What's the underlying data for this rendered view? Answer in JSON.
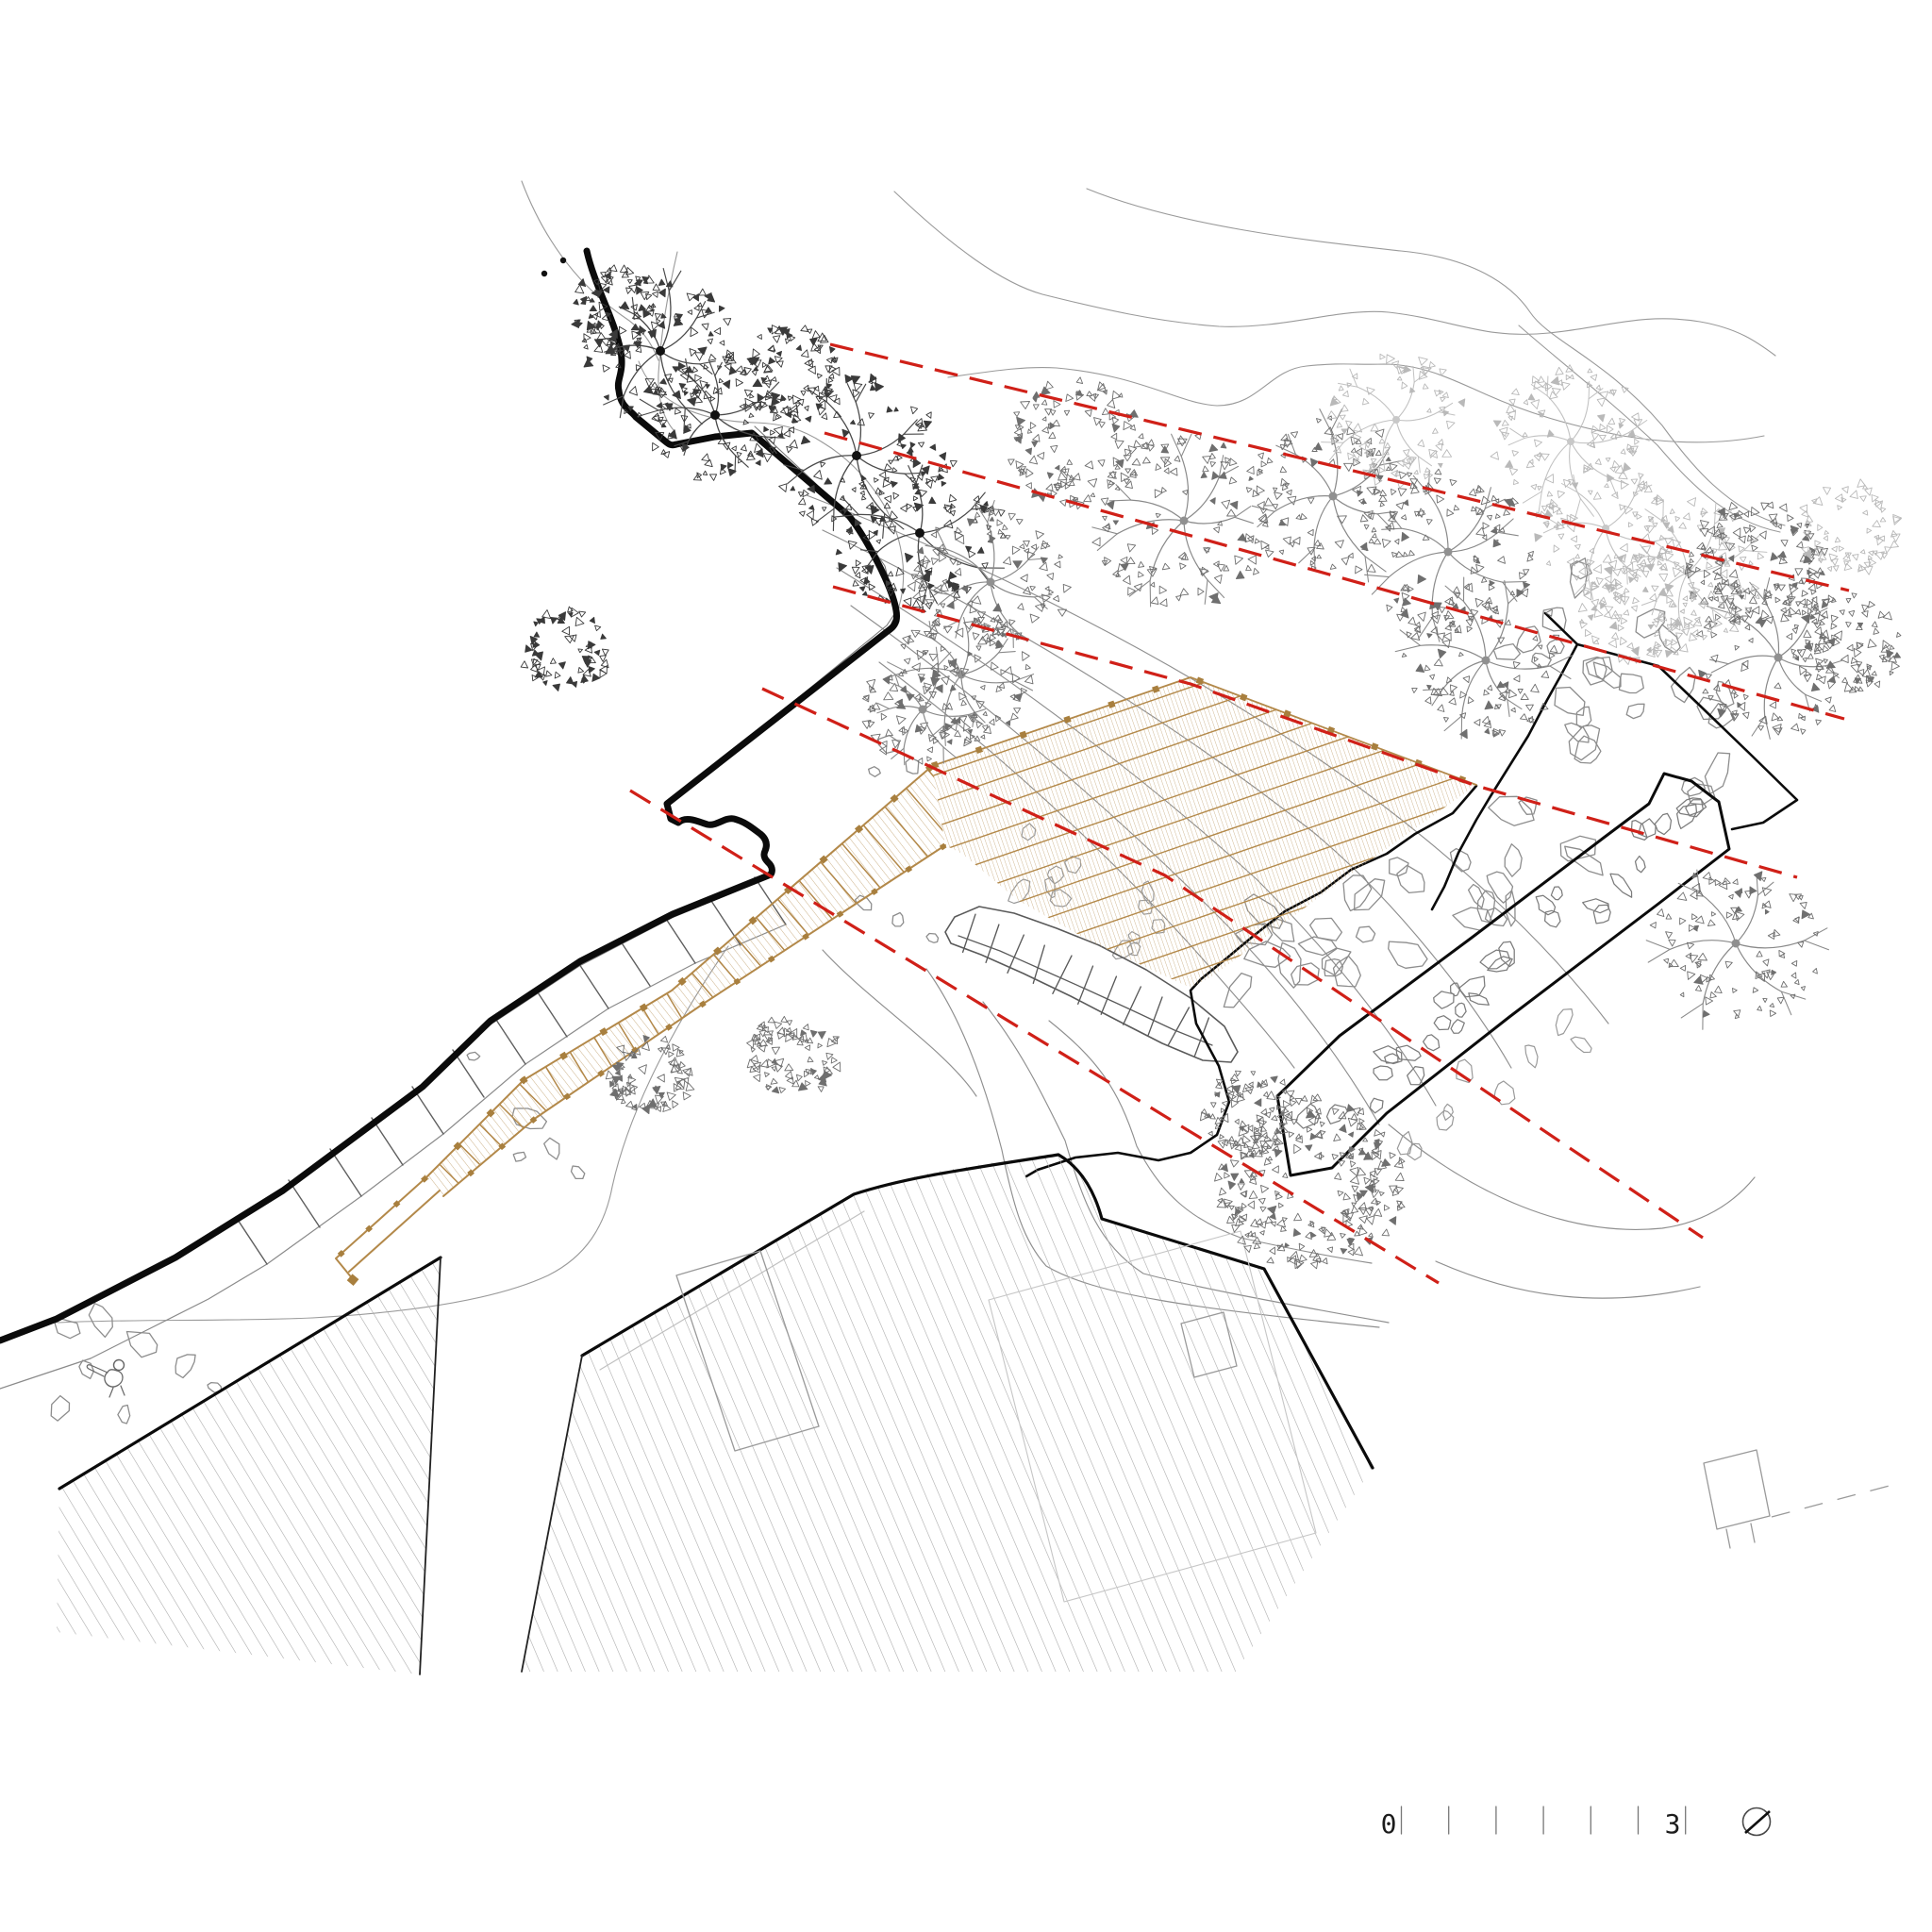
{
  "drawing": {
    "kind": "architectural-site-plan",
    "elements": {
      "deck": "timber-deck",
      "boardwalk": "timber-boardwalk",
      "breakwater": "stone-breakwater",
      "coastline": "coastline",
      "roofs": "hatched-building-roofs",
      "sight_lines": "red-dashed-sight-lines"
    }
  },
  "scale_bar": {
    "start_label": "0",
    "end_label": "3",
    "ticks": 7
  },
  "north_arrow": {
    "icon": "north-arrow-icon"
  },
  "colors": {
    "background": "#ffffff",
    "ink": "#0b0b0b",
    "contour_gray": "#9a9a9a",
    "slope_gray": "#8f8f8f",
    "light_gray": "#c3c3c3",
    "stone_gray": "#8d8d8d",
    "stone_dark": "#7c7c7c",
    "wall_gray": "#5a5a5a",
    "divider_gray": "#5f5f5f",
    "roof_hatch": "#a9a9a9",
    "timber_fine": "#cdb38a",
    "timber_main": "#b3894a",
    "timber_dot": "#a87f3e",
    "sightline_red": "#d02018",
    "tree_dark": "#4a4a4a",
    "tree_mid": "#8a8a8a",
    "tree_light": "#c2c2c2"
  }
}
